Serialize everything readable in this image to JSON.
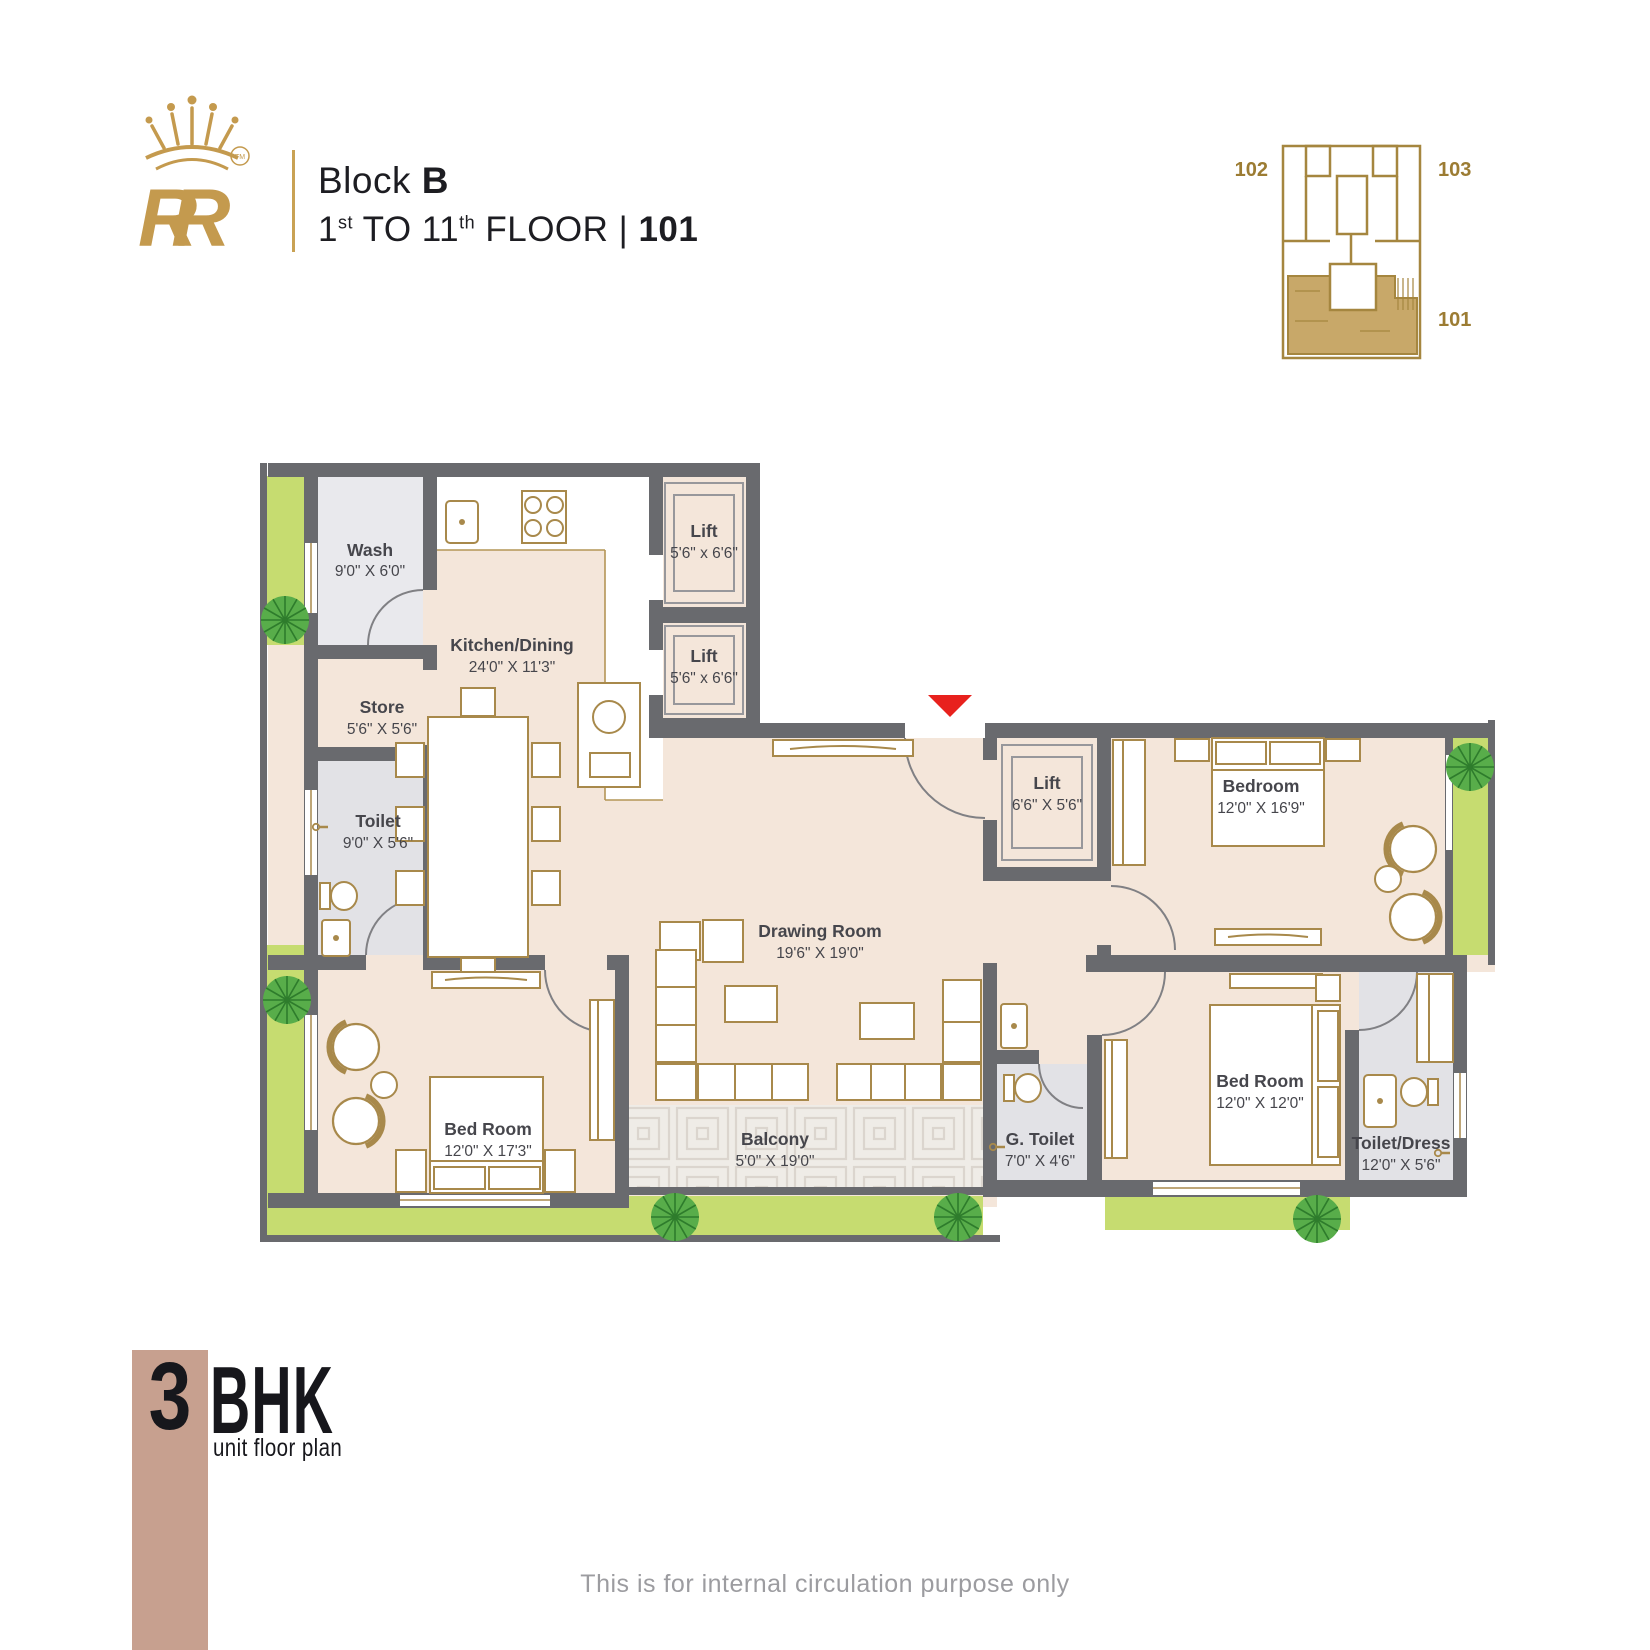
{
  "header": {
    "logo_text": "RR",
    "logo_tm": "TM",
    "block_line": {
      "prefix": "Block ",
      "bold": "B"
    },
    "floor_line": {
      "n1": "1",
      "sup1": "st",
      "mid": " TO 11",
      "sup2": "th",
      "rest": " FLOOR |",
      "unit": " 101"
    }
  },
  "key_plan": {
    "labels": {
      "left": "102",
      "right_top": "103",
      "right_bottom": "101"
    }
  },
  "plan": {
    "rooms": [
      {
        "name": "Wash",
        "dim": "9'0\" X 6'0\""
      },
      {
        "name": "Kitchen/Dining",
        "dim": "24'0\" X 11'3\""
      },
      {
        "name": "Store",
        "dim": "5'6\" X 5'6\""
      },
      {
        "name": "Toilet",
        "dim": "9'0\" X 5'6\""
      },
      {
        "name": "Lift",
        "dim": "5'6\" x 6'6\""
      },
      {
        "name": "Lift",
        "dim": "5'6\" x 6'6\""
      },
      {
        "name": "Lift",
        "dim": "6'6\" X 5'6\""
      },
      {
        "name": "Bedroom",
        "dim": "12'0\" X 16'9\""
      },
      {
        "name": "Drawing Room",
        "dim": "19'6\" X 19'0\""
      },
      {
        "name": "Bed Room",
        "dim": "12'0\" X 17'3\""
      },
      {
        "name": "Balcony",
        "dim": "5'0\" X 19'0\""
      },
      {
        "name": "G. Toilet",
        "dim": "7'0\" X 4'6\""
      },
      {
        "name": "Bed Room",
        "dim": "12'0\" X 12'0\""
      },
      {
        "name": "Toilet/Dress",
        "dim": "12'0\" X 5'6\""
      }
    ]
  },
  "footer": {
    "big_number": "3",
    "big_label": "BHK",
    "sub_label": "unit floor plan"
  },
  "disclaimer": "This is for internal circulation purpose only",
  "colors": {
    "logo_gold": "#c49a4e",
    "furniture_gold": "#a8894b",
    "wall_gray": "#696a6e",
    "room_beige": "#f4e6da",
    "room_gray": "#e9e9ed",
    "planter_green": "#c6dc70",
    "tree_green": "#58ad4a",
    "keyplan_tan": "#c8a869",
    "entrance_red": "#e8211d",
    "footer_rose": "#c7a08f"
  }
}
